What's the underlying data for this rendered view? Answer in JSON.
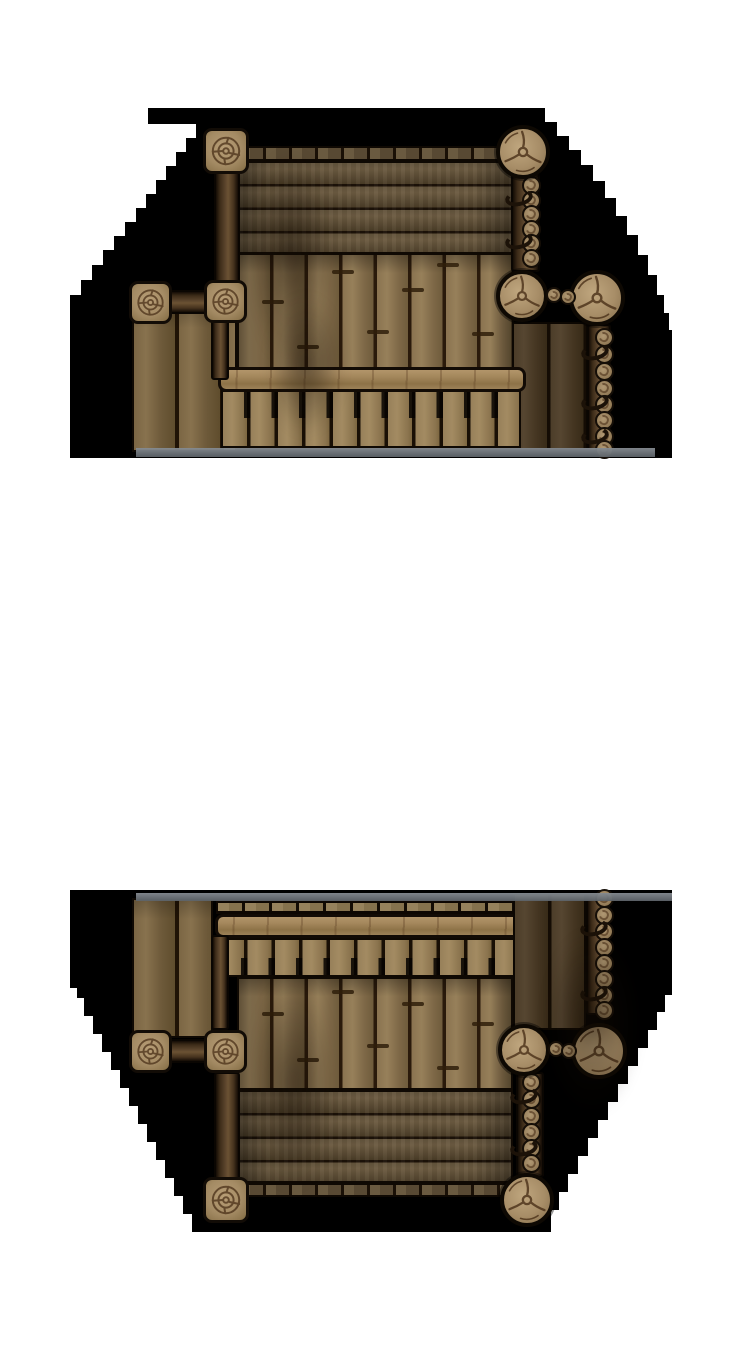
{
  "canvas": {
    "width": 750,
    "height": 1350,
    "background": "#ffffff"
  },
  "palette": {
    "fog": "#000000",
    "plank_light": "#a38b62",
    "plank_mid": "#8a7350",
    "plank_dark": "#4c3d29",
    "seam": "#1c1208",
    "beam_light": "#a4875c",
    "cap_wood": "#a48b64",
    "crack": "#4a3018",
    "water_edge": "#82888e"
  },
  "groups": [
    {
      "name": "dock-north",
      "fog_points": [
        [
          148,
          108
        ],
        [
          545,
          108
        ],
        [
          545,
          122
        ],
        [
          557,
          122
        ],
        [
          557,
          136
        ],
        [
          569,
          136
        ],
        [
          569,
          150
        ],
        [
          581,
          150
        ],
        [
          581,
          165
        ],
        [
          593,
          165
        ],
        [
          593,
          181
        ],
        [
          605,
          181
        ],
        [
          605,
          198
        ],
        [
          616,
          198
        ],
        [
          616,
          216
        ],
        [
          627,
          216
        ],
        [
          627,
          235
        ],
        [
          638,
          235
        ],
        [
          638,
          255
        ],
        [
          648,
          255
        ],
        [
          648,
          275
        ],
        [
          657,
          275
        ],
        [
          657,
          295
        ],
        [
          664,
          295
        ],
        [
          664,
          313
        ],
        [
          669,
          313
        ],
        [
          669,
          330
        ],
        [
          672,
          330
        ],
        [
          672,
          458
        ],
        [
          70,
          458
        ],
        [
          70,
          295
        ],
        [
          81,
          295
        ],
        [
          81,
          280
        ],
        [
          92,
          280
        ],
        [
          92,
          265
        ],
        [
          103,
          265
        ],
        [
          103,
          250
        ],
        [
          114,
          250
        ],
        [
          114,
          236
        ],
        [
          125,
          236
        ],
        [
          125,
          222
        ],
        [
          136,
          222
        ],
        [
          136,
          208
        ],
        [
          146,
          208
        ],
        [
          146,
          194
        ],
        [
          156,
          194
        ],
        [
          156,
          180
        ],
        [
          166,
          180
        ],
        [
          166,
          166
        ],
        [
          176,
          166
        ],
        [
          176,
          152
        ],
        [
          186,
          152
        ],
        [
          186,
          138
        ],
        [
          196,
          138
        ],
        [
          196,
          124
        ],
        [
          148,
          124
        ]
      ],
      "elements": [
        {
          "t": "lplanks",
          "x": 132,
          "y": 306,
          "w": 105,
          "h": 146
        },
        {
          "t": "edge",
          "x": 238,
          "y": 146,
          "w": 276,
          "h": 15
        },
        {
          "t": "hplanks",
          "x": 237,
          "y": 161,
          "w": 277,
          "h": 93
        },
        {
          "t": "vplanks",
          "x": 237,
          "y": 253,
          "w": 277,
          "h": 117
        },
        {
          "t": "dplanks",
          "x": 512,
          "y": 322,
          "w": 76,
          "h": 128
        },
        {
          "t": "nplanks",
          "x": 221,
          "y": 390,
          "w": 300,
          "h": 58
        },
        {
          "t": "crossbeam",
          "x": 218,
          "y": 367,
          "w": 308,
          "h": 25
        },
        {
          "t": "beamv",
          "x": 214,
          "y": 168,
          "w": 26,
          "h": 140
        },
        {
          "t": "beamv",
          "x": 211,
          "y": 320,
          "w": 18,
          "h": 60
        },
        {
          "t": "beamh",
          "x": 166,
          "y": 290,
          "w": 44,
          "h": 24
        },
        {
          "t": "beamv",
          "x": 511,
          "y": 172,
          "w": 29,
          "h": 100
        },
        {
          "t": "logs",
          "x": 531,
          "r": 9.5,
          "ys": [
            185,
            200,
            214,
            229,
            243,
            258
          ]
        },
        {
          "t": "rope",
          "x": 505,
          "y": 190
        },
        {
          "t": "rope",
          "x": 505,
          "y": 233
        },
        {
          "t": "beamv",
          "x": 587,
          "y": 324,
          "w": 24,
          "h": 128
        },
        {
          "t": "logs",
          "x": 604,
          "r": 9.5,
          "ys": [
            337,
            354,
            371,
            388,
            404,
            420,
            436,
            449
          ]
        },
        {
          "t": "rope",
          "x": 581,
          "y": 344
        },
        {
          "t": "rope",
          "x": 581,
          "y": 394
        },
        {
          "t": "rope",
          "x": 581,
          "y": 428
        },
        {
          "t": "post",
          "cx": 226,
          "cy": 151,
          "s": 46
        },
        {
          "t": "post",
          "cx": 150,
          "cy": 302,
          "s": 43
        },
        {
          "t": "post",
          "cx": 225,
          "cy": 301,
          "s": 43
        },
        {
          "t": "piling",
          "cx": 523,
          "cy": 152,
          "r": 27
        },
        {
          "t": "piling",
          "cx": 522,
          "cy": 296,
          "r": 26
        },
        {
          "t": "piling",
          "cx": 597,
          "cy": 298,
          "r": 28
        },
        {
          "t": "minilog",
          "cx": 554,
          "cy": 295,
          "r": 8
        },
        {
          "t": "minilog",
          "cx": 568,
          "cy": 297,
          "r": 8
        },
        {
          "t": "joint",
          "x": 262,
          "y": 300,
          "w": 22
        },
        {
          "t": "joint",
          "x": 297,
          "y": 345,
          "w": 22
        },
        {
          "t": "joint",
          "x": 332,
          "y": 270,
          "w": 22
        },
        {
          "t": "joint",
          "x": 367,
          "y": 330,
          "w": 22
        },
        {
          "t": "joint",
          "x": 402,
          "y": 288,
          "w": 22
        },
        {
          "t": "joint",
          "x": 437,
          "y": 263,
          "w": 22
        },
        {
          "t": "joint",
          "x": 472,
          "y": 332,
          "w": 22
        },
        {
          "t": "smudge",
          "x": 248,
          "y": 150,
          "w": 85,
          "h": 215
        },
        {
          "t": "smudge",
          "x": 268,
          "y": 295,
          "w": 75,
          "h": 140
        },
        {
          "t": "strip",
          "x": 136,
          "y": 448,
          "w": 519,
          "h": 9
        }
      ]
    },
    {
      "name": "dock-south",
      "fog_points": [
        [
          70,
          890
        ],
        [
          672,
          890
        ],
        [
          672,
          995
        ],
        [
          665,
          995
        ],
        [
          665,
          1012
        ],
        [
          657,
          1012
        ],
        [
          657,
          1030
        ],
        [
          648,
          1030
        ],
        [
          648,
          1048
        ],
        [
          638,
          1048
        ],
        [
          638,
          1066
        ],
        [
          628,
          1066
        ],
        [
          628,
          1084
        ],
        [
          618,
          1084
        ],
        [
          618,
          1102
        ],
        [
          608,
          1102
        ],
        [
          608,
          1120
        ],
        [
          598,
          1120
        ],
        [
          598,
          1138
        ],
        [
          588,
          1138
        ],
        [
          588,
          1156
        ],
        [
          578,
          1156
        ],
        [
          578,
          1174
        ],
        [
          568,
          1174
        ],
        [
          568,
          1192
        ],
        [
          559,
          1192
        ],
        [
          559,
          1210
        ],
        [
          551,
          1210
        ],
        [
          551,
          1232
        ],
        [
          192,
          1232
        ],
        [
          192,
          1214
        ],
        [
          183,
          1214
        ],
        [
          183,
          1196
        ],
        [
          174,
          1196
        ],
        [
          174,
          1178
        ],
        [
          165,
          1178
        ],
        [
          165,
          1160
        ],
        [
          156,
          1160
        ],
        [
          156,
          1142
        ],
        [
          147,
          1142
        ],
        [
          147,
          1124
        ],
        [
          138,
          1124
        ],
        [
          138,
          1106
        ],
        [
          129,
          1106
        ],
        [
          129,
          1088
        ],
        [
          120,
          1088
        ],
        [
          120,
          1070
        ],
        [
          111,
          1070
        ],
        [
          111,
          1052
        ],
        [
          102,
          1052
        ],
        [
          102,
          1034
        ],
        [
          93,
          1034
        ],
        [
          93,
          1016
        ],
        [
          84,
          1016
        ],
        [
          84,
          998
        ],
        [
          77,
          998
        ],
        [
          77,
          988
        ],
        [
          70,
          988
        ]
      ],
      "elements": [
        {
          "t": "lplanks",
          "x": 132,
          "y": 898,
          "w": 81,
          "h": 140
        },
        {
          "t": "ticks",
          "x": 216,
          "y": 901,
          "w": 308,
          "h": 13
        },
        {
          "t": "nplanks",
          "flip": true,
          "x": 218,
          "y": 938,
          "w": 304,
          "h": 39
        },
        {
          "t": "crossbeam",
          "x": 215,
          "y": 914,
          "w": 310,
          "h": 24
        },
        {
          "t": "vplanks",
          "x": 237,
          "y": 977,
          "w": 276,
          "h": 113
        },
        {
          "t": "hplanks",
          "x": 237,
          "y": 1090,
          "w": 276,
          "h": 93
        },
        {
          "t": "edge",
          "x": 238,
          "y": 1183,
          "w": 276,
          "h": 14
        },
        {
          "t": "dplanks",
          "x": 513,
          "y": 893,
          "w": 73,
          "h": 137
        },
        {
          "t": "beamv",
          "x": 586,
          "y": 893,
          "w": 24,
          "h": 122
        },
        {
          "t": "logs",
          "x": 604,
          "r": 9.5,
          "ys": [
            898,
            915,
            931,
            947,
            963,
            979,
            995,
            1010
          ]
        },
        {
          "t": "rope",
          "x": 580,
          "y": 920
        },
        {
          "t": "rope",
          "x": 580,
          "y": 985
        },
        {
          "t": "beamv",
          "x": 211,
          "y": 935,
          "w": 18,
          "h": 95
        },
        {
          "t": "beamv",
          "x": 214,
          "y": 1072,
          "w": 26,
          "h": 108
        },
        {
          "t": "beamh",
          "x": 166,
          "y": 1039,
          "w": 44,
          "h": 24
        },
        {
          "t": "beamv",
          "x": 516,
          "y": 1072,
          "w": 28,
          "h": 106
        },
        {
          "t": "logs",
          "x": 531,
          "r": 9.5,
          "ys": [
            1082,
            1099,
            1116,
            1132,
            1148,
            1163
          ]
        },
        {
          "t": "rope",
          "x": 510,
          "y": 1088
        },
        {
          "t": "rope",
          "x": 510,
          "y": 1140
        },
        {
          "t": "post",
          "cx": 150,
          "cy": 1051,
          "s": 43
        },
        {
          "t": "post",
          "cx": 225,
          "cy": 1051,
          "s": 43
        },
        {
          "t": "post",
          "cx": 226,
          "cy": 1200,
          "s": 46
        },
        {
          "t": "piling",
          "cx": 524,
          "cy": 1050,
          "r": 26
        },
        {
          "t": "piling",
          "cx": 599,
          "cy": 1051,
          "r": 28
        },
        {
          "t": "piling",
          "cx": 527,
          "cy": 1200,
          "r": 27
        },
        {
          "t": "minilog",
          "cx": 556,
          "cy": 1049,
          "r": 8
        },
        {
          "t": "minilog",
          "cx": 569,
          "cy": 1051,
          "r": 8
        },
        {
          "t": "joint",
          "x": 262,
          "y": 1012,
          "w": 22
        },
        {
          "t": "joint",
          "x": 297,
          "y": 1058,
          "w": 22
        },
        {
          "t": "joint",
          "x": 332,
          "y": 990,
          "w": 22
        },
        {
          "t": "joint",
          "x": 367,
          "y": 1044,
          "w": 22
        },
        {
          "t": "joint",
          "x": 402,
          "y": 1002,
          "w": 22
        },
        {
          "t": "joint",
          "x": 437,
          "y": 1066,
          "w": 22
        },
        {
          "t": "joint",
          "x": 472,
          "y": 1022,
          "w": 22
        },
        {
          "t": "smudge",
          "x": 250,
          "y": 975,
          "w": 85,
          "h": 215
        },
        {
          "t": "smudge",
          "x": 545,
          "y": 930,
          "w": 95,
          "h": 185
        },
        {
          "t": "strip",
          "x": 136,
          "y": 893,
          "w": 536,
          "h": 8
        }
      ]
    }
  ]
}
